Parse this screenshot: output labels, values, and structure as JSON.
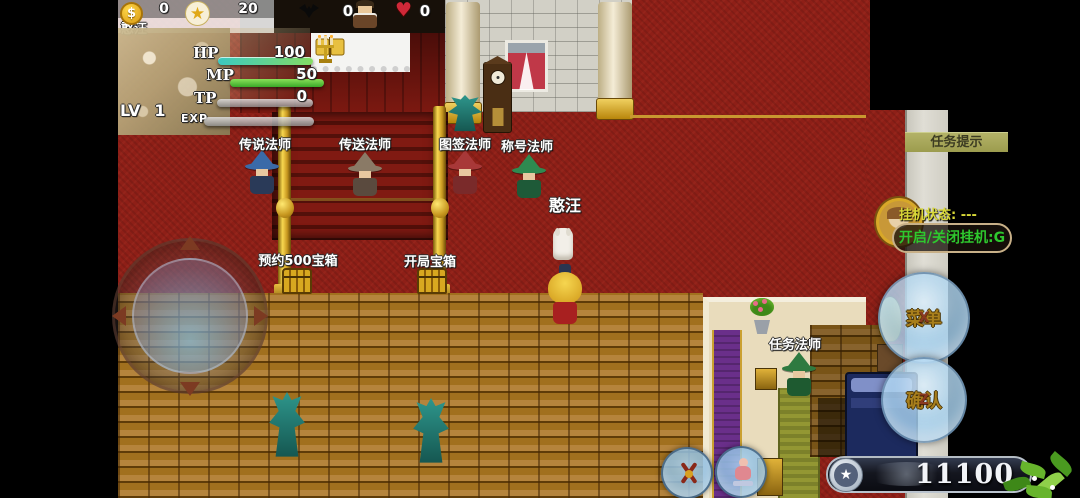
{
  "hud": {
    "player_name": "憨汪",
    "gold_count": "0",
    "star_count": "20",
    "kill_count": "0",
    "heart_count": "0",
    "stats": {
      "hp_label": "HP",
      "hp_value": "100",
      "mp_label": "MP",
      "mp_value": "50",
      "tp_label": "TP",
      "tp_value": "0",
      "lv_label": "LV",
      "lv_value": "1",
      "exp_label": "EXP"
    }
  },
  "npcs": [
    {
      "label": "传说法师"
    },
    {
      "label": "传送法师"
    },
    {
      "label": "图签法师"
    },
    {
      "label": "称号法师"
    },
    {
      "label": "任务法师"
    }
  ],
  "map_labels": {
    "player_tag": "憨汪",
    "chest1": "预约500宝箱",
    "chest2": "开局宝箱"
  },
  "quest_panel": {
    "title": "任务提示"
  },
  "idle_panel": {
    "status_text": "挂机状态: ---",
    "toggle_label": "开启/关闭挂机:G"
  },
  "touch_buttons": {
    "menu_label": "菜单",
    "menu_key": "X",
    "confirm_label": "确认",
    "confirm_key": "Z"
  },
  "currency_bar": {
    "value": "11100",
    "icon": "star"
  },
  "icons": [
    "coin-icon",
    "star-icon",
    "kill-bat-icon",
    "heart-icon",
    "crest-icon",
    "pray-icon",
    "joystick"
  ],
  "colors": {
    "hp_bar": "#3cc8c0",
    "mp_bar": "#52c23c",
    "carpet_red": "#8e1f17",
    "brick_gold": "#a5761f",
    "gold_trim": "#c89830",
    "quest_bar_bg": "#a9a95e",
    "idle_toggle_text": "#2ec82e",
    "touch_button_blue": "#aed4ee"
  }
}
